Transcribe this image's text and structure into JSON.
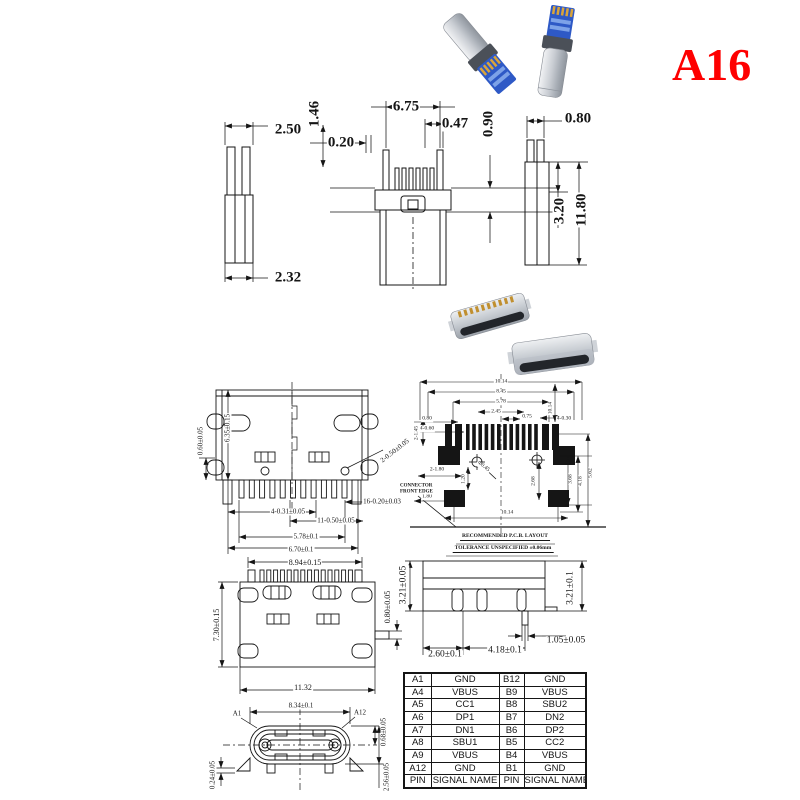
{
  "badge": {
    "text": "A16",
    "color": "#fe0000"
  },
  "photos": {
    "top": "usb-type-c-plug-connectors-photo",
    "middle": "usb-type-c-receptacle-connectors-photo"
  },
  "dims": {
    "plug": [
      "2.50",
      "1.46",
      "6.75",
      "0.47",
      "0.20",
      "0.90",
      "0.80",
      "3.20",
      "11.80",
      "2.32"
    ],
    "top_view": [
      "0.60±0.05",
      "6.35±0.15",
      "2-0.50±0.05",
      "4-0.31±0.05",
      "16-0.20±0.03",
      "11-0.50±0.05",
      "5.78±0.1",
      "6.70±0.1"
    ],
    "pcb": [
      "10.14",
      "8.45",
      "5.78",
      "2.45",
      "0.75",
      "0.80",
      "4-0.60",
      "2-1.45",
      "2-1.80",
      "1.20",
      "1.80",
      "Φ0.45",
      "4-0.30",
      "10.14",
      "2.68",
      "3.68",
      "4.18",
      "5.62",
      "10.14"
    ],
    "front_view": [
      "8.94±0.15",
      "7.30±0.15",
      "0.80±0.05",
      "11.32"
    ],
    "side_view": [
      "3.21±0.05",
      "3.21±0.1",
      "1.05±0.05",
      "2.60±0.1",
      "4.18±0.1"
    ],
    "face_view": [
      "8.34±0.1",
      "A1",
      "A12",
      "0.68±0.05",
      "2.56±0.05",
      "0.24±0.05"
    ]
  },
  "pcb_notes": {
    "edge": "CONNECTOR FRONT EDGE",
    "line1": "RECOMMENDED P.C.B. LAYOUT",
    "line2": "TOLERANCE UNSPECIFIED ±0.06mm"
  },
  "pin_table": {
    "rows": [
      [
        "A1",
        "GND",
        "B12",
        "GND"
      ],
      [
        "A4",
        "VBUS",
        "B9",
        "VBUS"
      ],
      [
        "A5",
        "CC1",
        "B8",
        "SBU2"
      ],
      [
        "A6",
        "DP1",
        "B7",
        "DN2"
      ],
      [
        "A7",
        "DN1",
        "B6",
        "DP2"
      ],
      [
        "A8",
        "SBU1",
        "B5",
        "CC2"
      ],
      [
        "A9",
        "VBUS",
        "B4",
        "VBUS"
      ],
      [
        "A12",
        "GND",
        "B1",
        "GND"
      ],
      [
        "PIN",
        "SIGNAL NAME",
        "PIN",
        "SIGNAL NAME"
      ]
    ]
  }
}
